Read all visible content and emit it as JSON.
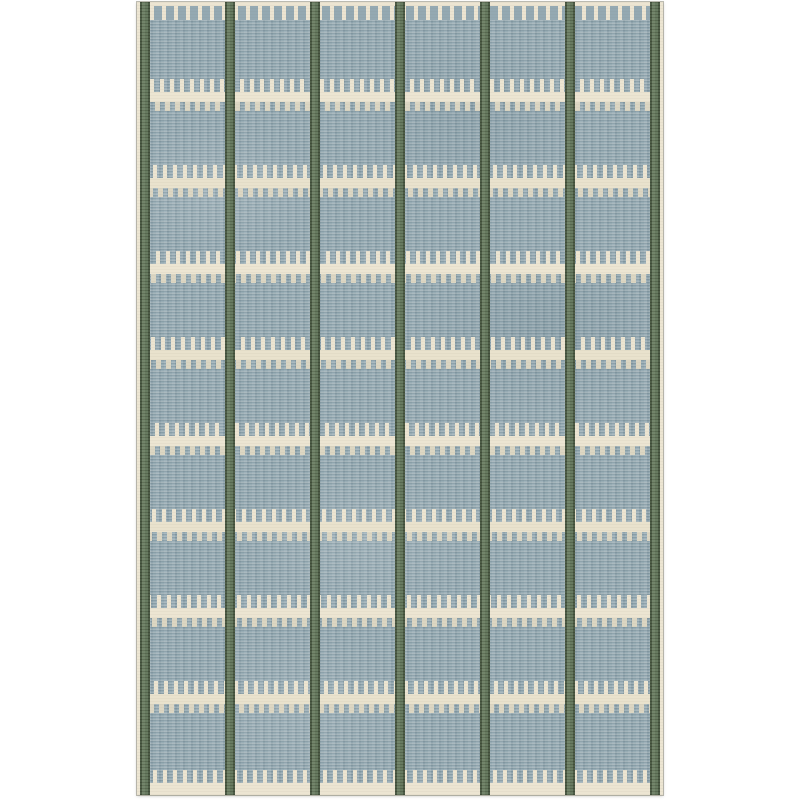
{
  "page": {
    "background": "#ffffff",
    "description": "Product image of a Swedish-style flatweave wool rug on a plain white background"
  },
  "rug": {
    "description": "Slate-blue flatweave rug with six columns separated by dark sage-green pinstripes; rows of ivory comb-stitch motifs (long teeth above a solid bar, short stub teeth below); crenellated ivory bands along the top and bottom edges; thin ivory selvedge on the left and right sides",
    "colors": {
      "field": "#94a9b2",
      "field_light": "#a9bbc2",
      "field_dark": "#7e949e",
      "stripe": "#5f7357",
      "stripe_light": "#6b7e62",
      "stripe_edge": "#45543d",
      "cream": "#ece5d2",
      "cream_alt": "#e9e2cd",
      "cream_soft": "#e0d9c4",
      "edge_line": "#c8c4b4"
    },
    "pattern": {
      "width": 526,
      "height": 793,
      "top_offset": 2,
      "columns": 6,
      "stripe_count": 7,
      "stripe_width": 10,
      "edge_width": 3,
      "motif_rows": 8,
      "first_bar_y": 90,
      "row_spacing": 86,
      "bar_height": 10,
      "tooth_up_height": 13,
      "tooth_up_width": 4,
      "tooth_down_height": 9,
      "tooth_down_width": 5,
      "tooth_pitch": 10,
      "top_band_height": 18,
      "top_band_tooth_top": 4,
      "top_tooth_width": 8,
      "top_tooth_pitch": 12,
      "bottom_band_height": 12,
      "bottom_teeth_height": 13,
      "row_shifts": [
        0,
        3,
        6,
        1,
        5,
        2,
        7,
        4
      ]
    }
  }
}
